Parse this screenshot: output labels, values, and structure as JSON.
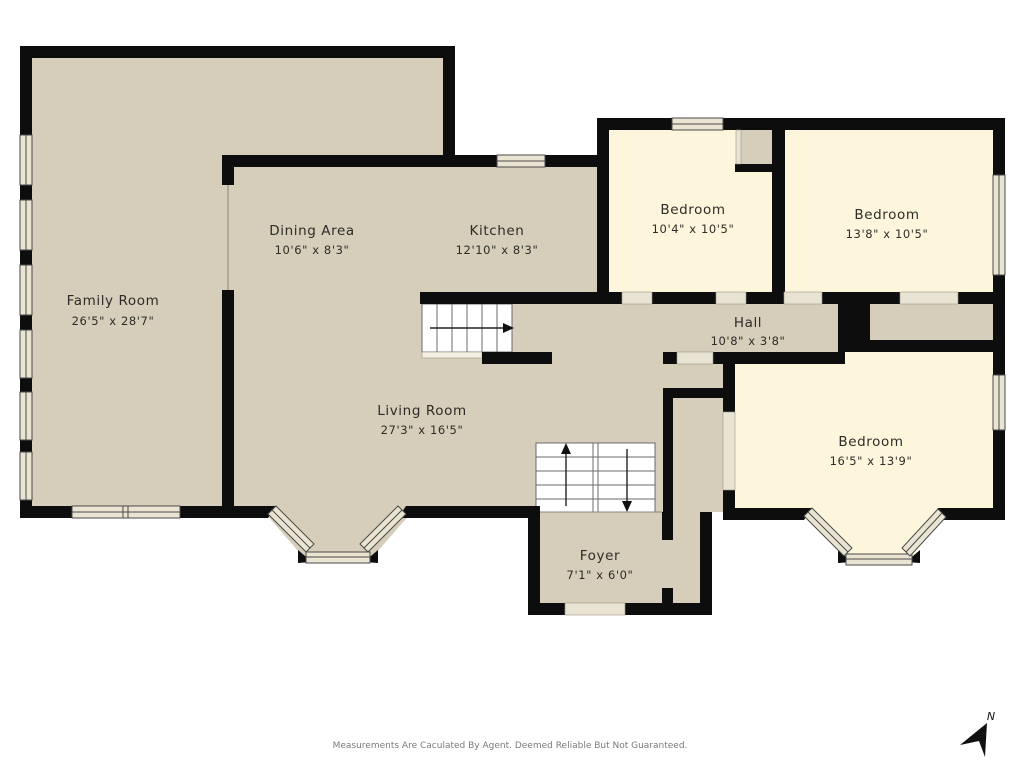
{
  "rooms": [
    {
      "name": "Family Room",
      "dims": "26'5\" x 28'7\""
    },
    {
      "name": "Dining Area",
      "dims": "10'6\" x 8'3\""
    },
    {
      "name": "Kitchen",
      "dims": "12'10\" x 8'3\""
    },
    {
      "name": "Bedroom",
      "dims": "10'4\" x 10'5\""
    },
    {
      "name": "Bedroom",
      "dims": "13'8\" x 10'5\""
    },
    {
      "name": "Hall",
      "dims": "10'8\" x 3'8\""
    },
    {
      "name": "Living Room",
      "dims": "27'3\" x 16'5\""
    },
    {
      "name": "Bedroom",
      "dims": "16'5\" x 13'9\""
    },
    {
      "name": "Foyer",
      "dims": "7'1\" x 6'0\""
    }
  ],
  "disclaimer": "Measurements Are Caculated By Agent. Deemed Reliable But Not Guaranteed.",
  "compass_label": "N",
  "colors": {
    "background": "#ffffff",
    "floor_main": "#d6cdba",
    "floor_bedroom": "#fdf6dc",
    "wall": "#0d0d0d",
    "window": "#eae4d3"
  }
}
